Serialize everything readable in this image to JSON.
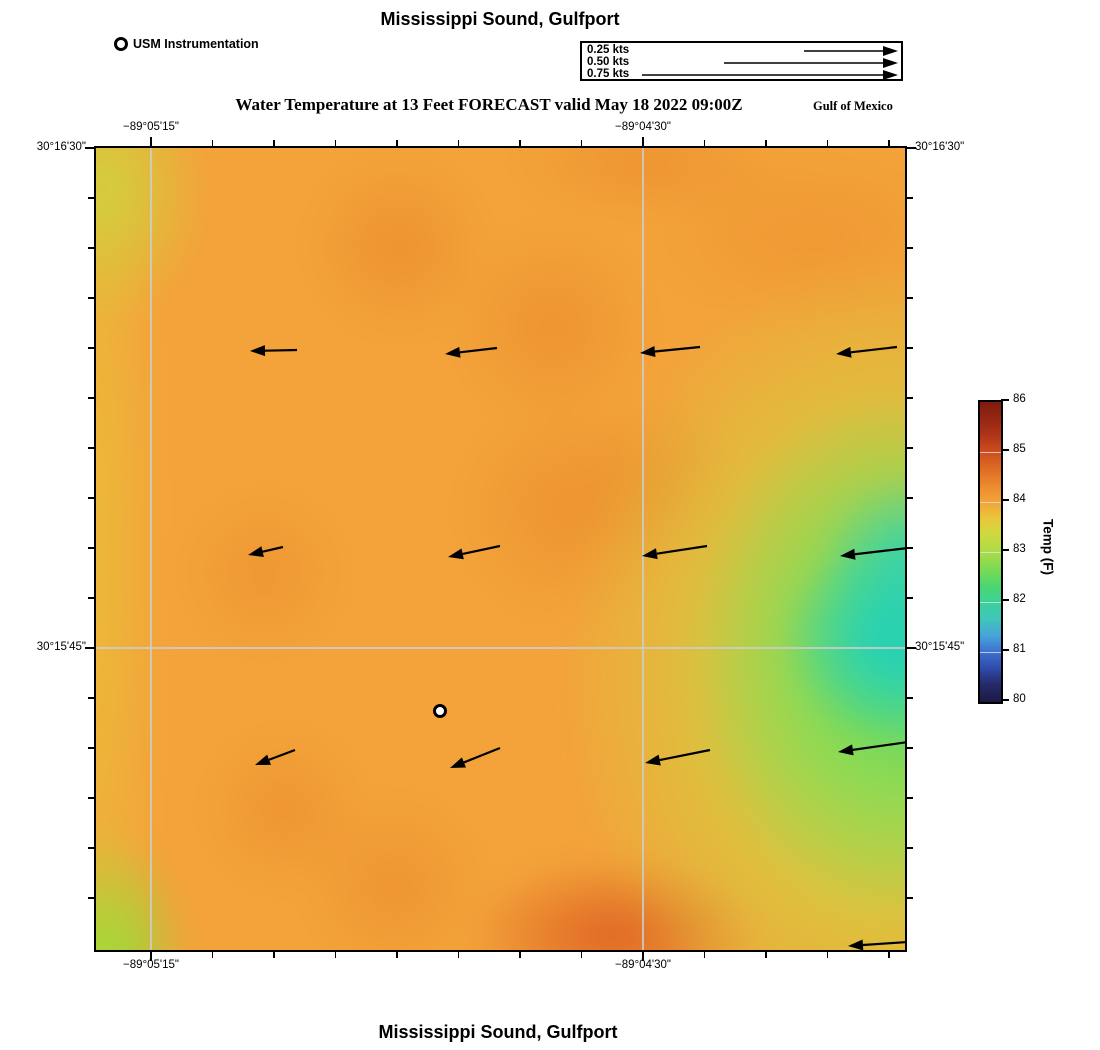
{
  "header": {
    "title": "Mississippi Sound, Gulfport",
    "usm_label": "USM Instrumentation",
    "subtitle": "Water Temperature at 13 Feet FORECAST valid May 18 2022 09:00Z",
    "region_label": "Gulf of Mexico"
  },
  "footer": {
    "title": "Mississippi Sound, Gulfport"
  },
  "velocity_legend": {
    "rows": [
      {
        "label": "0.25 kts",
        "start_x": 222
      },
      {
        "label": "0.50 kts",
        "start_x": 142
      },
      {
        "label": "0.75 kts",
        "start_x": 60
      }
    ],
    "tip_x": 316,
    "row_ys": [
      8,
      20,
      32
    ]
  },
  "map": {
    "lon_tick_labels": [
      {
        "label": "−89°05'15\"",
        "x": 55
      },
      {
        "label": "−89°04'30\"",
        "x": 547
      }
    ],
    "lat_tick_labels": [
      {
        "label": "30°16'30\"",
        "y": 0
      },
      {
        "label": "30°15'45\"",
        "y": 500
      }
    ],
    "x_tick_start": 55,
    "x_tick_spacing": 61.5,
    "x_tick_count": 13,
    "x_major_indices": [
      0,
      8
    ],
    "y_tick_start": 0,
    "y_tick_spacing": 50,
    "y_tick_count": 16,
    "y_major_indices": [
      0,
      10
    ],
    "gridlines_x": [
      55,
      547
    ],
    "gridlines_y": [
      500
    ],
    "station": {
      "x": 344,
      "y": 563
    },
    "arrows": [
      {
        "x1": 201,
        "y1": 202,
        "x2": 154,
        "y2": 203
      },
      {
        "x1": 401,
        "y1": 200,
        "x2": 349,
        "y2": 206
      },
      {
        "x1": 604,
        "y1": 199,
        "x2": 544,
        "y2": 205
      },
      {
        "x1": 801,
        "y1": 199,
        "x2": 740,
        "y2": 206
      },
      {
        "x1": 187,
        "y1": 399,
        "x2": 152,
        "y2": 407
      },
      {
        "x1": 404,
        "y1": 398,
        "x2": 352,
        "y2": 409
      },
      {
        "x1": 611,
        "y1": 398,
        "x2": 546,
        "y2": 408
      },
      {
        "x1": 812,
        "y1": 400,
        "x2": 744,
        "y2": 408
      },
      {
        "x1": 199,
        "y1": 602,
        "x2": 159,
        "y2": 617
      },
      {
        "x1": 404,
        "y1": 600,
        "x2": 354,
        "y2": 620
      },
      {
        "x1": 614,
        "y1": 602,
        "x2": 549,
        "y2": 615
      },
      {
        "x1": 812,
        "y1": 594,
        "x2": 742,
        "y2": 604
      },
      {
        "x1": 812,
        "y1": 794,
        "x2": 752,
        "y2": 798
      }
    ]
  },
  "colorbar": {
    "label": "Temp (F)",
    "tick_labels": [
      "86",
      "85",
      "84",
      "83",
      "82",
      "81",
      "80"
    ],
    "stops": [
      [
        0,
        "#1c1942"
      ],
      [
        6,
        "#262a6b"
      ],
      [
        11,
        "#2e4aa8"
      ],
      [
        16.7,
        "#3e70d0"
      ],
      [
        22,
        "#47a3da"
      ],
      [
        27.5,
        "#41c4bb"
      ],
      [
        33.3,
        "#3ad29b"
      ],
      [
        39,
        "#4ed76d"
      ],
      [
        44.5,
        "#7eda53"
      ],
      [
        50,
        "#abdc48"
      ],
      [
        56,
        "#cfd93e"
      ],
      [
        61,
        "#e9c73a"
      ],
      [
        66.7,
        "#f2a338"
      ],
      [
        72,
        "#eb8b2e"
      ],
      [
        78,
        "#dc6a24"
      ],
      [
        83.3,
        "#cd4e1e"
      ],
      [
        90,
        "#a93116"
      ],
      [
        100,
        "#7c1b10"
      ]
    ]
  },
  "chart_data": {
    "type": "heatmap",
    "title": "Water Temperature at 13 Feet FORECAST valid May 18 2022 09:00Z",
    "region": "Mississippi Sound, Gulfport",
    "basin_label": "Gulf of Mexico",
    "colorbar_label": "Temp (F)",
    "colorbar_range": [
      80,
      86
    ],
    "colorbar_ticks": [
      80,
      81,
      82,
      83,
      84,
      85,
      86
    ],
    "lon_ticks": [
      "−89°05'15\"",
      "−89°04'30\""
    ],
    "lat_ticks": [
      "30°16'30\"",
      "30°15'45\""
    ],
    "current_scale_kts": [
      0.25,
      0.5,
      0.75
    ],
    "field_summary": "Field mostly ~84°F (orange); cool 81–82°F teal patch on east edge mid-map; 82–83°F green/yellow-green band along east side; ~83°F yellow-green at west edge and SW/NW corners; warmer ~85°F orange-red patch south-center; current vectors point west ~0.25–0.5 kts"
  }
}
